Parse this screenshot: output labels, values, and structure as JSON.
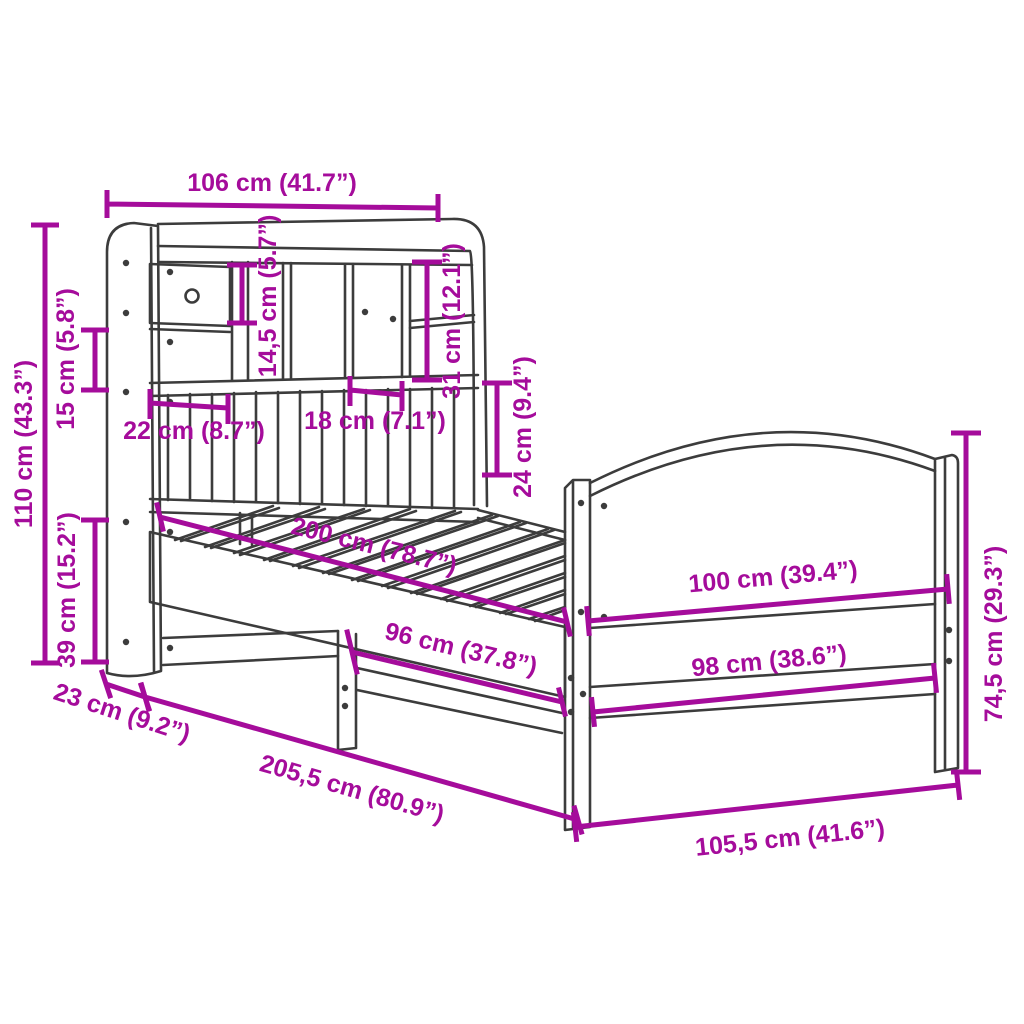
{
  "colors": {
    "background": "#FFFFFF",
    "line": "#3C3C3C",
    "dimension": "#A50C9B"
  },
  "dims": {
    "w106": "106 cm (41.7”)",
    "h110": "110 cm (43.3”)",
    "h15": "15 cm (5.8”)",
    "h39": "39 cm (15.2”)",
    "h14_5": "14,5 cm (5.7”)",
    "h31": "31 cm (12.1”)",
    "w22": "22 cm (8.7”)",
    "w18": "18 cm (7.1”)",
    "h24": "24 cm (9.4”)",
    "l200": "200 cm (78.7”)",
    "l96": "96 cm (37.8”)",
    "d23": "23 cm (9.2”)",
    "l205_5": "205,5 cm (80.9”)",
    "w105_5": "105,5 cm (41.6”)",
    "w100": "100 cm (39.4”)",
    "w98": "98 cm (38.6”)",
    "h74_5": "74,5 cm (29.3”)"
  }
}
